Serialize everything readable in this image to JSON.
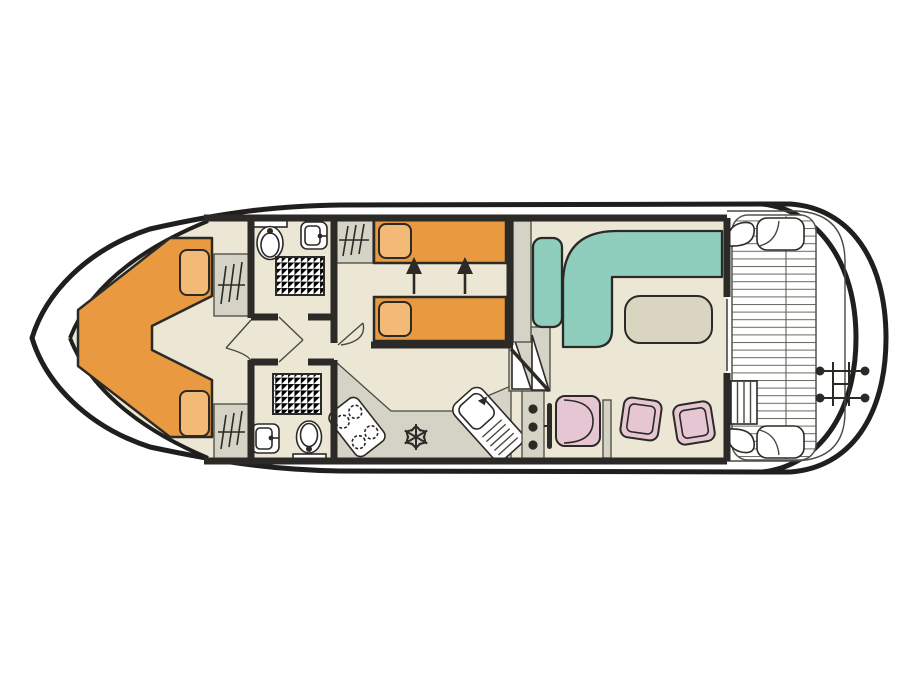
{
  "diagram": {
    "type": "houseboat-deck-plan",
    "orientation": "bow-left-stern-right",
    "areas": [
      {
        "name": "bow-cabin",
        "furniture": [
          "v-berth-double-bed",
          "pillow-top",
          "pillow-bottom",
          "wardrobe-top",
          "wardrobe-bottom"
        ]
      },
      {
        "name": "bathroom-forward",
        "furniture": [
          "toilet",
          "washbasin",
          "shower",
          "shelf"
        ]
      },
      {
        "name": "bathroom-aft",
        "furniture": [
          "toilet",
          "washbasin",
          "shower",
          "shelf"
        ]
      },
      {
        "name": "middle-cabin",
        "furniture": [
          "single-bed-top",
          "single-bed-bottom",
          "pillows",
          "wardrobe",
          "slide-together-arrows"
        ]
      },
      {
        "name": "galley",
        "furniture": [
          "counter",
          "stove-4-burner",
          "fridge-freezer-snowflake",
          "sink-with-drainboard"
        ]
      },
      {
        "name": "helm",
        "furniture": [
          "instrument-console",
          "steering-wheel",
          "helm-seat"
        ]
      },
      {
        "name": "saloon",
        "furniture": [
          "steps",
          "side-cabinet",
          "bench-seat",
          "l-shaped-sofa",
          "table",
          "stool-1",
          "stool-2"
        ]
      },
      {
        "name": "aft-deck",
        "furniture": [
          "plank-deck",
          "corner-seat-top",
          "corner-seat-bottom",
          "deck-steps",
          "swim-ladder",
          "cleats"
        ]
      }
    ],
    "icons": [
      "hanger-icon",
      "toilet-icon",
      "shower-grid-icon",
      "snowflake-icon",
      "burner-icon",
      "arrow-up-icon",
      "ladder-icon"
    ]
  },
  "colors": {
    "hull": "#1f1f1d",
    "wall": "#2b2a26",
    "thin": "#4a4942",
    "floor": "#ece7d5",
    "furn_grey": "#d5d3c6",
    "bed_orange": "#e9993f",
    "pillow_orange": "#f2b977",
    "sofa_teal": "#8fcdbc",
    "chair_pink": "#e7c6d4",
    "table_grey": "#d9d5c1",
    "deck_line": "#6a695f"
  }
}
